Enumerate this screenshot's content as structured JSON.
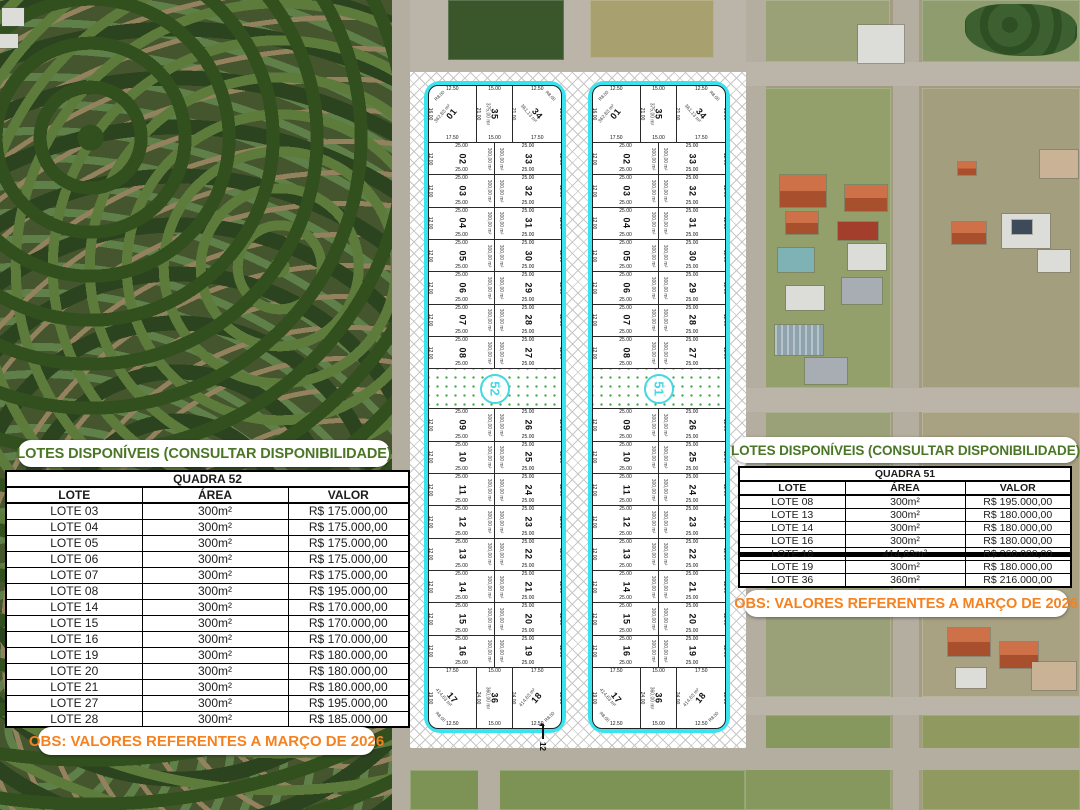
{
  "colors": {
    "accent_cyan": "#3AE4EF",
    "accent_cyan_deep": "#45D7E3",
    "title_green": "#4A7626",
    "obs_orange": "#F58220",
    "dot_green": "#43AD4C"
  },
  "banners": {
    "availability_title": "LOTES DISPONÍVEIS (CONSULTAR DISPONIBILIDADE)",
    "obs_note": "OBS: VALORES REFERENTES A MARÇO DE 2026"
  },
  "tables": [
    {
      "title": "QUADRA 52",
      "columns": [
        "LOTE",
        "ÁREA",
        "VALOR"
      ],
      "rows": [
        {
          "lote": "LOTE 03",
          "area": "300m²",
          "valor": "R$ 175.000,00",
          "struck": false
        },
        {
          "lote": "LOTE 04",
          "area": "300m²",
          "valor": "R$ 175.000,00",
          "struck": false
        },
        {
          "lote": "LOTE 05",
          "area": "300m²",
          "valor": "R$ 175.000,00",
          "struck": false
        },
        {
          "lote": "LOTE 06",
          "area": "300m²",
          "valor": "R$ 175.000,00",
          "struck": false
        },
        {
          "lote": "LOTE 07",
          "area": "300m²",
          "valor": "R$ 175.000,00",
          "struck": false
        },
        {
          "lote": "LOTE 08",
          "area": "300m²",
          "valor": "R$ 195.000,00",
          "struck": false
        },
        {
          "lote": "LOTE 14",
          "area": "300m²",
          "valor": "R$ 170.000,00",
          "struck": false
        },
        {
          "lote": "LOTE 15",
          "area": "300m²",
          "valor": "R$ 170.000,00",
          "struck": false
        },
        {
          "lote": "LOTE 16",
          "area": "300m²",
          "valor": "R$ 170.000,00",
          "struck": false
        },
        {
          "lote": "LOTE 19",
          "area": "300m²",
          "valor": "R$ 180.000,00",
          "struck": false
        },
        {
          "lote": "LOTE 20",
          "area": "300m²",
          "valor": "R$ 180.000,00",
          "struck": false
        },
        {
          "lote": "LOTE 21",
          "area": "300m²",
          "valor": "R$ 180.000,00",
          "struck": false
        },
        {
          "lote": "LOTE 27",
          "area": "300m²",
          "valor": "R$ 195.000,00",
          "struck": false
        },
        {
          "lote": "LOTE 28",
          "area": "300m²",
          "valor": "R$ 185.000,00",
          "struck": false
        }
      ]
    },
    {
      "title": "QUADRA 51",
      "columns": [
        "LOTE",
        "ÁREA",
        "VALOR"
      ],
      "rows": [
        {
          "lote": "LOTE 08",
          "area": "300m²",
          "valor": "R$ 195.000,00",
          "struck": false
        },
        {
          "lote": "LOTE 13",
          "area": "300m²",
          "valor": "R$ 180.000,00",
          "struck": false
        },
        {
          "lote": "LOTE 14",
          "area": "300m²",
          "valor": "R$ 180.000,00",
          "struck": false
        },
        {
          "lote": "LOTE 16",
          "area": "300m²",
          "valor": "R$ 180.000,00",
          "struck": false
        },
        {
          "lote": "LOTE 18",
          "area": "414,63m²",
          "valor": "R$ 260.000,00",
          "struck": true
        },
        {
          "lote": "LOTE 19",
          "area": "300m²",
          "valor": "R$ 180.000,00",
          "struck": false
        },
        {
          "lote": "LOTE 36",
          "area": "360m²",
          "valor": "R$ 216.000,00",
          "struck": false
        }
      ]
    }
  ],
  "plat": {
    "street_label": "12",
    "band_index": 7,
    "pair_width_label": "25.00",
    "pair_side_label": "12.00",
    "pair_area_label": "300,00 m²",
    "pairs": [
      [
        "02",
        "33"
      ],
      [
        "03",
        "32"
      ],
      [
        "04",
        "31"
      ],
      [
        "05",
        "30"
      ],
      [
        "06",
        "29"
      ],
      [
        "07",
        "28"
      ],
      [
        "08",
        "27"
      ],
      [
        "09",
        "26"
      ],
      [
        "10",
        "25"
      ],
      [
        "11",
        "24"
      ],
      [
        "12",
        "23"
      ],
      [
        "13",
        "22"
      ],
      [
        "14",
        "21"
      ],
      [
        "15",
        "20"
      ],
      [
        "16",
        "19"
      ]
    ],
    "top_row": [
      {
        "num": "01",
        "area": "362,83 m²",
        "top": "12.50",
        "bottom": "17.50",
        "side": "16.00",
        "corner": "R8.00"
      },
      {
        "num": "35",
        "area": "375,00 m²",
        "top": "15.00",
        "bottom": "15.00",
        "side": "21.00"
      },
      {
        "num": "34",
        "area": "361,13 m²",
        "top": "12.50",
        "bottom": "17.50",
        "side": "16.00",
        "corner": "R8.00"
      }
    ],
    "bottom_row": [
      {
        "num": "17",
        "area": "414,63 m²",
        "top": "17.50",
        "bottom": "12.50",
        "side": "19.00",
        "corner": "R8.00"
      },
      {
        "num": "36",
        "area": "360,00 m²",
        "top": "15.00",
        "bottom": "15.00",
        "side": "24.00"
      },
      {
        "num": "18",
        "area": "414,63 m²",
        "top": "17.50",
        "bottom": "12.50",
        "side": "19.00",
        "corner": "R8.00"
      }
    ],
    "blocks": [
      {
        "number": "52"
      },
      {
        "number": "51"
      }
    ]
  }
}
